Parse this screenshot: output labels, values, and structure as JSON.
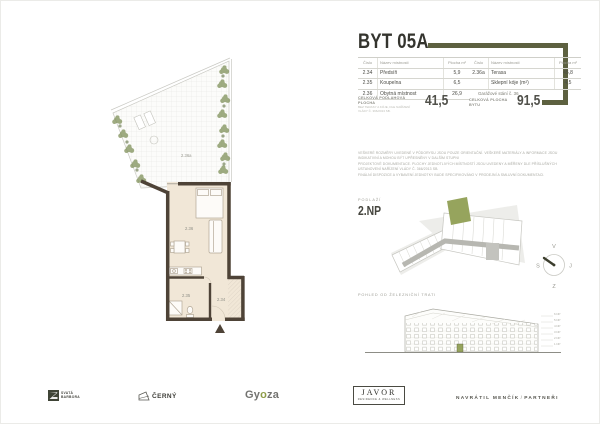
{
  "title": "BYT 05A",
  "colors": {
    "accent": "#5d6140",
    "accent_light": "#96a45d",
    "wall": "#4e4337",
    "floor": "#f1e7d7"
  },
  "tables": {
    "headers": {
      "num": "Číslo",
      "name": "Název místnosti",
      "area": "Plocha m²"
    },
    "left": {
      "rows": [
        {
          "num": "2.34",
          "name": "Předsíň",
          "area": "5,9"
        },
        {
          "num": "2.35",
          "name": "Koupelna",
          "area": "6,5"
        },
        {
          "num": "2.36",
          "name": "Obytná místnost",
          "area": "26,9"
        }
      ]
    },
    "right": {
      "rows": [
        {
          "num": "2.36a",
          "name": "Terasa",
          "area": "45,8"
        },
        {
          "num": "",
          "name": "Sklepní kóje (m²)",
          "area": "4,5"
        }
      ],
      "footer": "Garážové stání č. 36"
    }
  },
  "totals": {
    "left": {
      "label": "CELKOVÁ PODLAHOVÁ PLOCHA",
      "sublabel": "BEZ TERASY A KÓJE, DLE NAŘÍZENÍ VLÁDY Č. 366/2013 SB.",
      "value": "41,5"
    },
    "right": {
      "label": "CELKOVÁ PLOCHA BYTU",
      "value": "91,5"
    }
  },
  "disclaimer": {
    "line1": "VEŠKERÉ ROZMĚRY UVEDENÉ V PŮDORYSU JSOU POUZE ORIENTAČNÍ. VEŠKERÉ MATERIÁLY A INFORMACE JSOU INDIKATIVNÍ A MOHOU BÝT UPŘESNĚNY V DALŠÍM STUPNI",
    "line2": "PROJEKTOVÉ DOKUMENTACE. PLOCHY JEDNOTLIVÝCH MÍSTNOSTÍ JSOU UVEDENY A MĚŘENY DLE PŘÍSLUŠNÝCH USTANOVENÍ NAŘÍZENÍ VLÁDY Č. 366/2013 SB.",
    "line3": "FINÁLNÍ DISPOZICE A VYBAVENÍ JEDNOTKY BUDE SPECIFIKOVÁNO V PRODEJNÍ A SMLUVNÍ DOKUMENTACI."
  },
  "floor": {
    "label": "PODLAŽÍ",
    "value": "2.NP"
  },
  "compass": {
    "north": "S",
    "south": "J",
    "east": "V",
    "west": "Z"
  },
  "elevation": {
    "label": "POHLED OD ŽELEZNIČNÍ TRATI",
    "levels": [
      "6.NP",
      "5.NP",
      "4.NP",
      "3.NP",
      "2.NP",
      "1.NP"
    ]
  },
  "plan": {
    "room_labels": {
      "terrace": "2.36a",
      "living": "2.36",
      "bath": "2.35",
      "hall": "2.34"
    }
  },
  "logos": {
    "svata_line1": "SVATÁ",
    "svata_line2": "BARBORA",
    "cerny": "ČERNÝ",
    "gyoza_gy": "Gy",
    "gyoza_o": "o",
    "gyoza_za": "za",
    "javor": "JAVOR",
    "javor_sub": "RESIDENCE & WELLNESS",
    "navratil": "NAVRÁTIL MENČÍK",
    "navratil_sep": "/",
    "navratil_partner": "PARTNEŘI"
  }
}
